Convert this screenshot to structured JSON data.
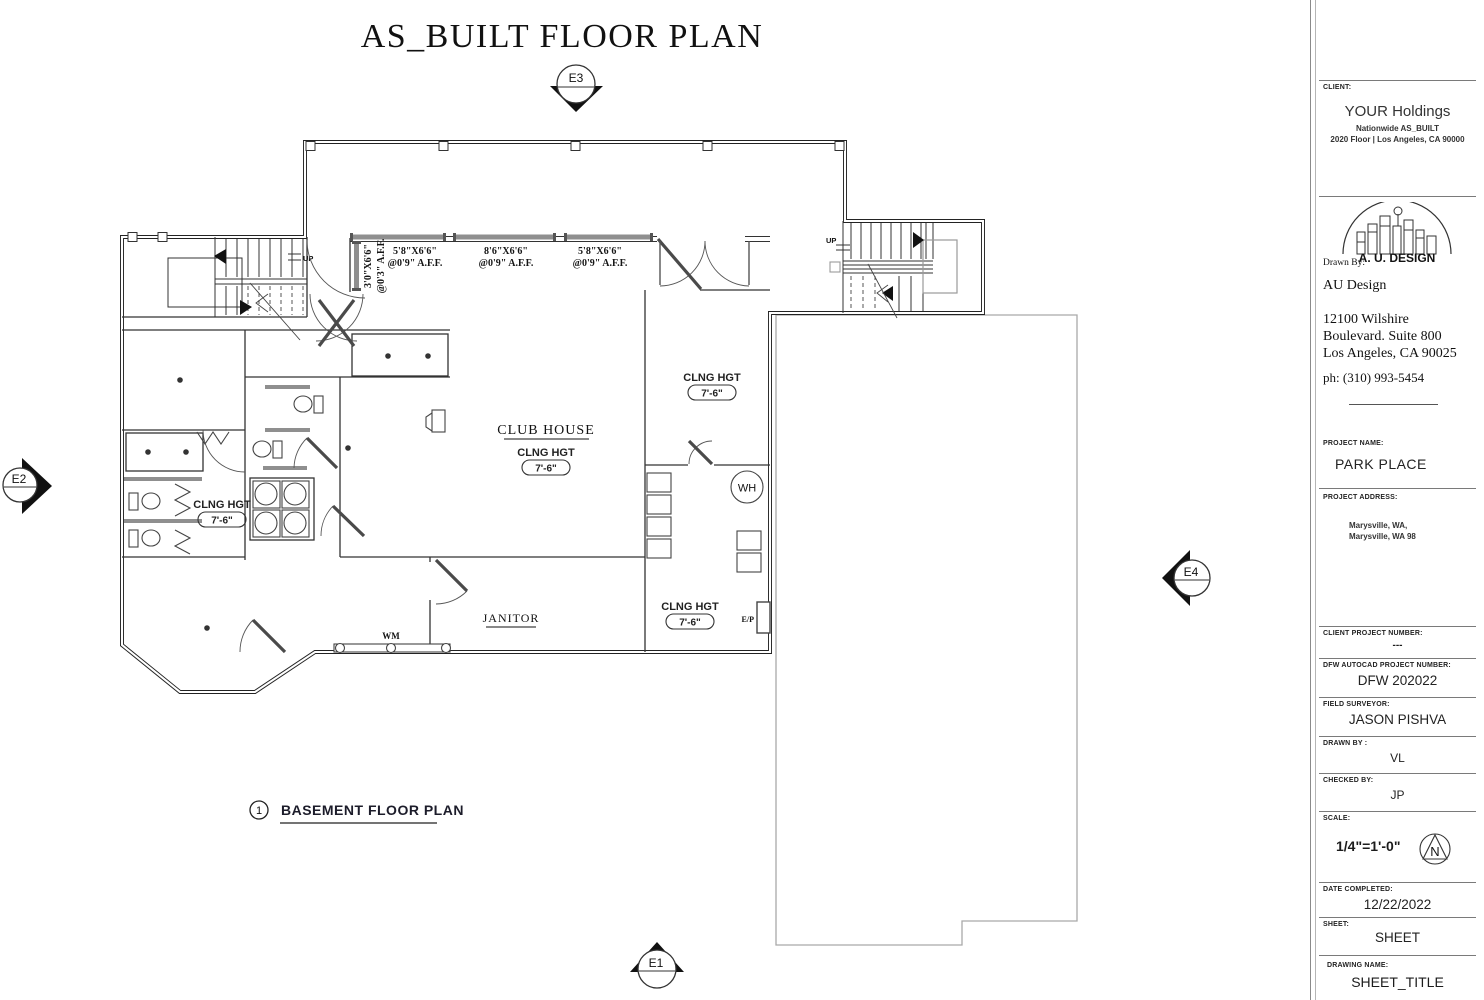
{
  "page": {
    "title": "AS_BUILT FLOOR PLAN",
    "caption_number": "1",
    "caption": "BASEMENT FLOOR PLAN"
  },
  "markers": {
    "top": "E3",
    "left": "E2",
    "right": "E4",
    "bottom": "E1"
  },
  "plan": {
    "rooms": {
      "club_house": {
        "name": "CLUB HOUSE",
        "ceiling_label": "CLNG HGT",
        "ceiling_height": "7'-6\""
      },
      "upper_right": {
        "ceiling_label": "CLNG HGT",
        "ceiling_height": "7'-6\""
      },
      "left_restroom": {
        "ceiling_label": "CLNG HGT",
        "ceiling_height": "7'-6\""
      },
      "lower_right": {
        "ceiling_label": "CLNG HGT",
        "ceiling_height": "7'-6\""
      },
      "janitor": {
        "name": "JANITOR"
      }
    },
    "labels": {
      "washing_machine": "WM",
      "water_heater": "WH",
      "electrical_panel": "E/P",
      "stairs_up_left": "UP",
      "stairs_up_right": "UP"
    },
    "windows": [
      {
        "size": "3'0\"X6'6\"",
        "mount": "@0'3\" A.F.F."
      },
      {
        "size": "5'8\"X6'6\"",
        "mount": "@0'9\" A.F.F."
      },
      {
        "size": "8'6\"X6'6\"",
        "mount": "@0'9\" A.F.F."
      },
      {
        "size": "5'8\"X6'6\"",
        "mount": "@0'9\" A.F.F."
      }
    ]
  },
  "titleblock": {
    "client_label": "CLIENT:",
    "client_name": "YOUR Holdings",
    "client_line2": "Nationwide AS_BUILT",
    "client_line3": "2020 Floor | Los Angeles, CA 90000",
    "logo_text": "A. U. DESIGN",
    "drawn_by_label": "Drawn By:",
    "firm_name": "AU Design",
    "firm_address1": "12100 Wilshire",
    "firm_address2": "Boulevard. Suite 800",
    "firm_address3": "Los Angeles, CA 90025",
    "firm_phone": "ph: (310) 993-5454",
    "project_name_label": "PROJECT NAME:",
    "project_name": "PARK PLACE",
    "project_address_label": "PROJECT ADDRESS:",
    "project_address1": "Marysville, WA,",
    "project_address2": "Marysville, WA 98",
    "client_project_number_label": "CLIENT PROJECT NUMBER:",
    "client_project_number": "---",
    "autocad_label": "DFW AUTOCAD PROJECT NUMBER:",
    "autocad_number": "DFW 202022",
    "field_surveyor_label": "FIELD SURVEYOR:",
    "field_surveyor": "JASON PISHVA",
    "drawn_by2_label": "DRAWN BY :",
    "drawn_by2": "VL",
    "checked_by_label": "CHECKED BY:",
    "checked_by": "JP",
    "scale_label": "SCALE:",
    "scale": "1/4\"=1'-0\"",
    "north_letter": "N",
    "date_label": "DATE COMPLETED:",
    "date": "12/22/2022",
    "sheet_label": "SHEET:",
    "sheet": "SHEET",
    "drawing_name_label": "DRAWING NAME:",
    "drawing_name": "SHEET_TITLE"
  }
}
